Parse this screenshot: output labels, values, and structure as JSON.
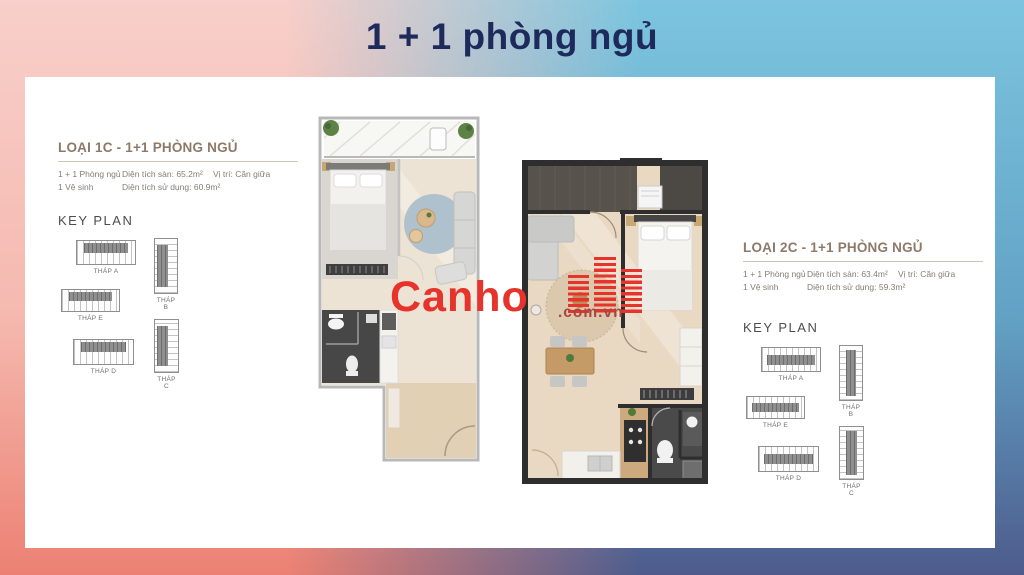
{
  "title": "1 + 1 phòng ngủ",
  "watermark": {
    "brand": "Canho",
    "domain": ".com.vn"
  },
  "colors": {
    "accent_red": "#e6332b",
    "title_navy": "#1e2a5c",
    "heading_taupe": "#8d7968",
    "bg_top_left": "#f8cfca",
    "bg_bottom_left": "#ec8173",
    "bg_top_right": "#7cc5df",
    "bg_bottom_right": "#4d5b8c"
  },
  "panels": [
    {
      "heading": "LOẠI 1C - 1+1 PHÒNG NGỦ",
      "specs": {
        "bedrooms": "1 + 1 Phòng ngủ",
        "bathrooms": "1 Vệ sinh",
        "floor_area": "Diện tích sàn: 65.2m²",
        "usable_area": "Diện tích sử dụng: 60.9m²",
        "position": "Vị trí: Căn giữa"
      },
      "keyplan_title": "KEY PLAN",
      "towers": [
        "THÁP A",
        "THÁP B",
        "THÁP E",
        "THÁP D",
        "THÁP C"
      ]
    },
    {
      "heading": "LOẠI 2C - 1+1 PHÒNG NGỦ",
      "specs": {
        "bedrooms": "1 + 1 Phòng ngủ",
        "bathrooms": "1 Vệ sinh",
        "floor_area": "Diện tích sàn: 63.4m²",
        "usable_area": "Diện tích sử dụng: 59.3m²",
        "position": "Vị trí: Căn giữa"
      },
      "keyplan_title": "KEY PLAN",
      "towers": [
        "THÁP A",
        "THÁP B",
        "THÁP E",
        "THÁP D",
        "THÁP C"
      ]
    }
  ]
}
